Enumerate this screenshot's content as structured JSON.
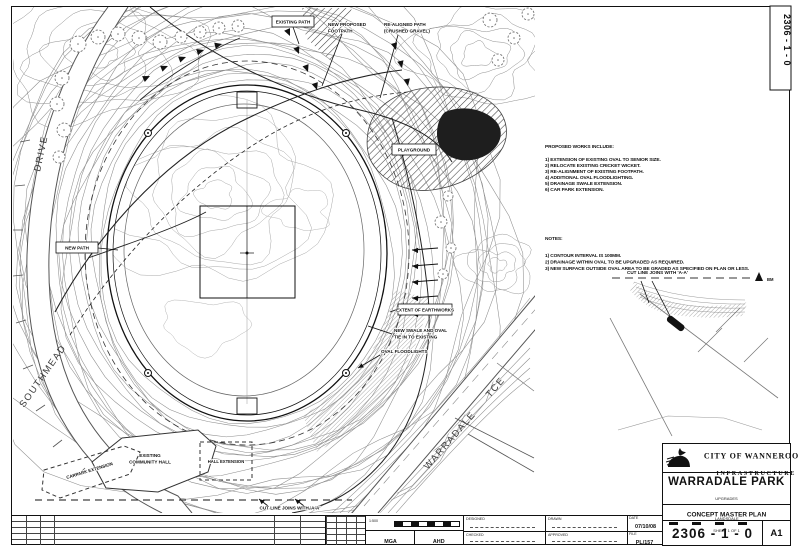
{
  "sheet": {
    "corner_number": "2306 - 1 - 0"
  },
  "streets": {
    "southmead": "SOUTHMEAD",
    "drive": "DRIVE",
    "warradale": "WARRADALE",
    "tce": "TCE"
  },
  "map_labels": {
    "new_path_box": "NEW PATH",
    "top_box": "EXISTING PATH",
    "footpath_line1": "NEW PROPOSED",
    "footpath_line2": "FOOTPATH",
    "realigned_line1": "RE-ALIGNED PATH",
    "realigned_line2": "(CRUSHED GRAVEL)",
    "playground_box": "PLAYGROUND",
    "extent_box": "EXTENT OF EARTHWORKS",
    "swale_line1": "NEW SWALE AND OVAL",
    "swale_line2": "TIE IN TO EXISTING",
    "floodlights": "OVAL FLOODLIGHTS",
    "hall_line1": "EXISTING",
    "hall_line2": "COMMUNITY HALL",
    "hall_extension": "HALL EXTENSION",
    "carpark": "CARPARK EXTENSION",
    "cut_line": "CUT LINE JOINS WITH 'A-A'"
  },
  "inset": {
    "cut_line": "CUT LINE JOINS WITH 'A-A'",
    "marker": "BM"
  },
  "proposed_works": {
    "title": "PROPOSED WORKS INCLUDE:",
    "items": [
      "1) EXTENSION OF EXISTING OVAL TO SENIOR SIZE.",
      "2) RELOCATE EXISTING CRICKET WICKET.",
      "3) RE-ALIGNMENT OF EXISTING FOOTPATH.",
      "4) ADDITIONAL OVAL FLOODLIGHTING.",
      "5) DRAINAGE SWALE EXTENSION.",
      "6) CAR PARK EXTENSION."
    ]
  },
  "notes": {
    "title": "NOTES:",
    "items": [
      "1) CONTOUR INTERVAL IS 100MM.",
      "2) DRAINAGE WITHIN OVAL TO BE UPGRADED AS REQUIRED.",
      "3) NEW SURFACE OUTSIDE OVAL AREA TO BE GRADED AS SPECIFIED ON PLAN OR LESS."
    ]
  },
  "strip": {
    "scale_value": "1:500",
    "datum_h": "MGA",
    "datum_v": "AHD",
    "designed": "DESIGNED",
    "drawn": "DRAWN",
    "checked": "CHECKED",
    "approved": "APPROVED",
    "date_label": "DATE",
    "date_value": "07/10/08",
    "file_label": "FILE",
    "file_value": "PL/157"
  },
  "title_block": {
    "org_line1": "CITY OF WANNEROO",
    "org_line2": "INFRASTRUCTURE",
    "project": "WARRADALE PARK",
    "subtitle": "UPGRADES",
    "locality": "LANDSDALE",
    "sheet_title": "CONCEPT MASTER PLAN",
    "sheet_of": "SHEET 1 OF 1",
    "number": "2306 - 1 - 0",
    "size": "A1"
  }
}
